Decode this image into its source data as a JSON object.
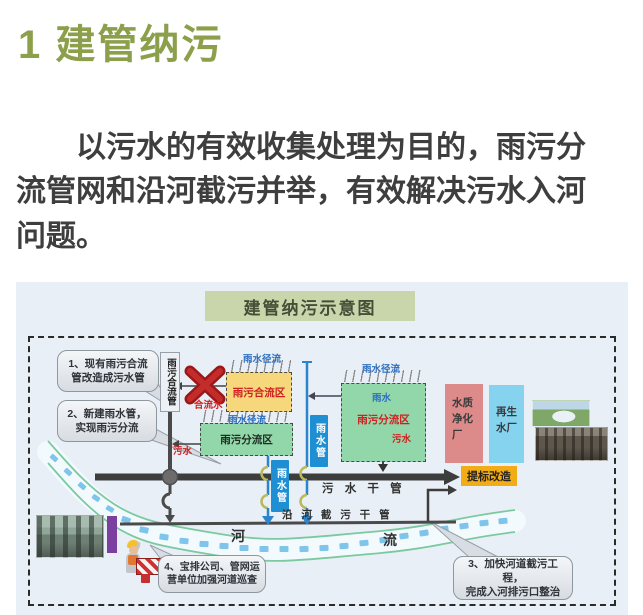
{
  "header": {
    "title": "1 建管纳污"
  },
  "intro": {
    "text": "　　以污水的有效收集处理为目的，雨污分\n流管网和沿河截污并举，有效解决污水入河\n问题。"
  },
  "diagram": {
    "title": "建管纳污示意图",
    "zones": {
      "combined": {
        "label": "雨污合流区"
      },
      "separated_a": {
        "label": "雨污分流区"
      },
      "separated_b": {
        "label": "雨污分流区",
        "rain": "雨水",
        "sewage": "污水"
      }
    },
    "pipes": {
      "combined_pipe": "雨污合流管",
      "storm_pipe_a": "雨水管",
      "storm_pipe_b": "雨水管",
      "sewage_main": "污 水 干 管",
      "interceptor": "沿 河 截 污 干 管"
    },
    "labels": {
      "runoff_combined": "雨水径流",
      "runoff_a": "雨水径流",
      "runoff_b": "雨水径流",
      "combined_water": "合流水",
      "sewage_out": "污水",
      "upgrade": "提标改造",
      "purification_plant": "水质\n净化\n厂",
      "reclaimed_plant": "再生\n水厂",
      "river_char_1": "河",
      "river_char_2": "流"
    },
    "callouts": {
      "c1": "1、现有雨污合流\n管改造成污水管",
      "c2": "2、新建雨水管，\n实现雨污分流",
      "c3": "3、加快河道截污工程，\n完成入河排污口整治",
      "c4": "4、宝排公司、管网运\n营单位加强河道巡查"
    }
  },
  "colors": {
    "olive": "#8CA04B",
    "sage": "#C9D6AB",
    "panel": "#E9EFF6",
    "yellowzone": "#F6D77C",
    "greenzone": "#92D7A9",
    "pipeblue": "#1E8FD2",
    "pink": "#DD8A8A",
    "cyan": "#85D3EE",
    "orange": "#F2AC15",
    "red": "#CF2020",
    "purple": "#7B3FA0",
    "textdark": "#3E3E3E"
  }
}
